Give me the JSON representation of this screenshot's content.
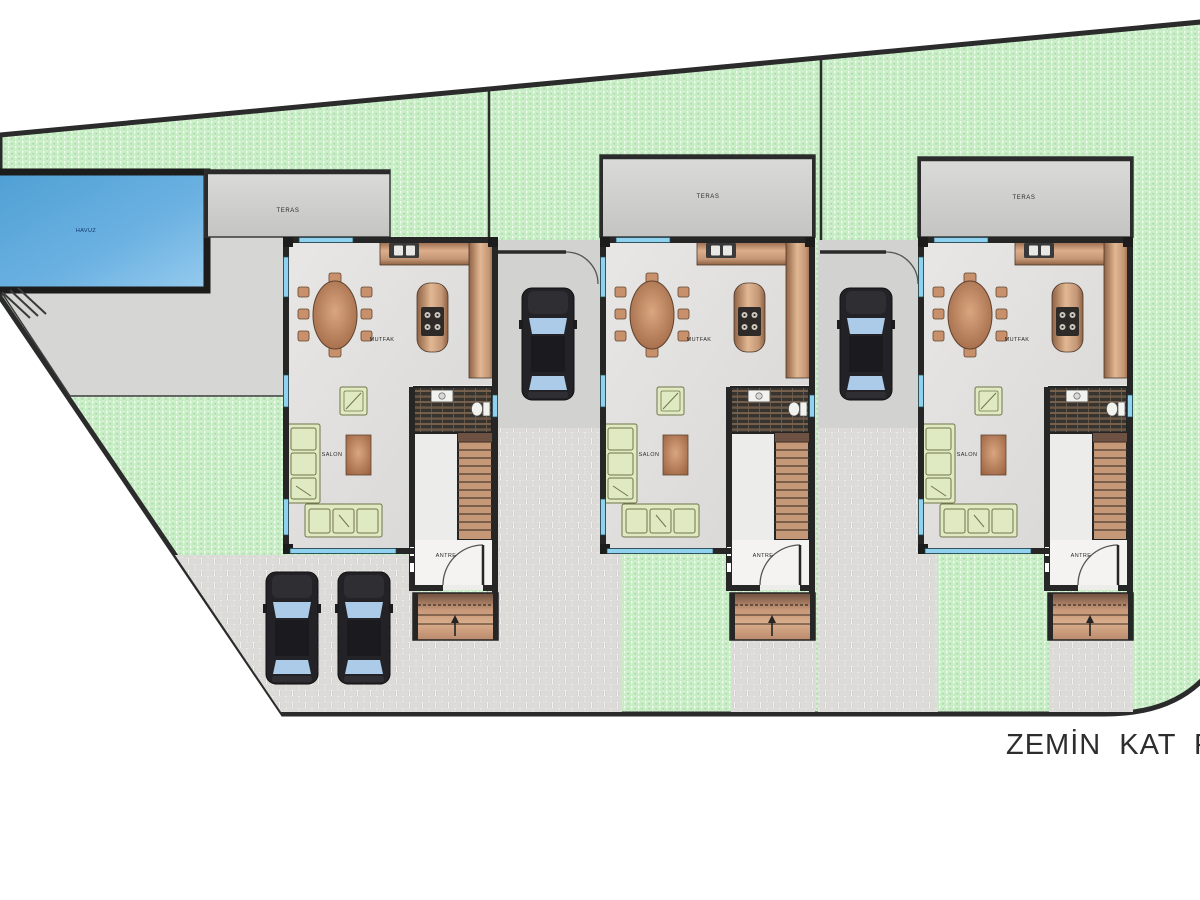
{
  "title": {
    "text": "ZEMİN KAT PLANI"
  },
  "site": {
    "pool_label": "HAVUZ",
    "units_count": 3,
    "cars_count": 4
  },
  "rooms": {
    "terrace": "TERAS",
    "kitchen": "MUTFAK",
    "living_room": "SALON",
    "entrance": "ANTRE"
  },
  "colors": {
    "garden_green": "#c7edc5",
    "garden_dot": "#a9d8a7",
    "boundary_dark": "#2b2b2b",
    "pool_blue": "#5aa6da",
    "deck_gray": "#d6d6d4",
    "terrace_gray": "#d2d2d0",
    "wall_dark": "#262626",
    "window_cyan": "#8ed2f0",
    "counter_tan": "#c08862",
    "sofa_green": "#dfe9c2",
    "stairs_tan": "#c59878",
    "brick_gray": "#dcdbd8",
    "car_body": "#232327",
    "car_glass": "#abcbe9",
    "title_color": "#2d2d2d"
  }
}
